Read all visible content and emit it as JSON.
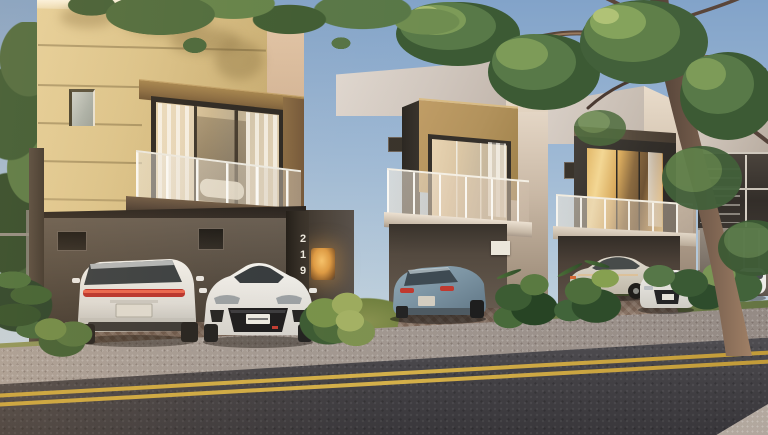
{
  "scene": {
    "type": "architectural-render",
    "description": "Golden-hour street view of a row of modern two-storey townhouses with glass balconies, carports with parked cars, tropical landscaping, a large leaning tree on the right and an asphalt road with a double yellow centre line in the foreground.",
    "house_number": "219",
    "time_of_day": "sunset golden hour",
    "houses": [
      {
        "id": "house-1",
        "facade_color": "#d9c289",
        "trim": "bronze",
        "features": [
          "textured yellow facade with horizontal grooves",
          "glass balcony railing",
          "sliding glass doors with white curtains",
          "small side window",
          "double carport",
          "unit number 219 on pillar",
          "wall lamp glow"
        ]
      },
      {
        "id": "house-2",
        "facade_color": "#d6cdc6",
        "trim": "tan",
        "features": [
          "white parapet",
          "tan window surround",
          "glass balcony",
          "single carport",
          "small white sign on carport wall"
        ]
      },
      {
        "id": "house-3",
        "facade_color": "#ccc4bc",
        "trim": "charcoal",
        "features": [
          "charcoal window box",
          "warm lit interior at dusk",
          "glass balcony",
          "carport"
        ]
      },
      {
        "id": "house-4",
        "facade_color": "#b3a899",
        "trim": "charcoal",
        "features": [
          "partially hidden behind large tree",
          "dark louvred window band"
        ]
      }
    ],
    "cars": [
      {
        "id": "white-suv-rear",
        "color": "#e9e8e4",
        "detail": "full-width red taillight bar, rear view",
        "position": "house-1 left bay"
      },
      {
        "id": "white-hatchback-front",
        "color": "#f2f1ed",
        "detail": "large black grille, front view",
        "position": "house-1 right bay"
      },
      {
        "id": "blue-grey-coupe",
        "color": "#7f99a8",
        "detail": "sloped rear glass, red taillights",
        "position": "house-2 carport"
      },
      {
        "id": "silver-sedan",
        "color": "#d3cdc0",
        "detail": "side view behind plants",
        "position": "house-3 carport"
      },
      {
        "id": "white-audi-front",
        "color": "#e8e6e2",
        "detail": "dark hexagonal grille",
        "position": "house-3 driveway"
      },
      {
        "id": "white-car-partial",
        "color": "#eceae6",
        "detail": "mostly hidden by shrubs",
        "position": "house-4 driveway"
      }
    ],
    "road": {
      "surface": "asphalt",
      "marking": "double yellow centre line",
      "marking_color": "#c8a23c"
    },
    "vegetation": [
      "dense trees on left edge",
      "large gnarled tree with green canopy on right",
      "tropical shrubs between driveways",
      "grass verge along sidewalk"
    ],
    "colors": {
      "sky_top": "#82a3c9",
      "sky_bottom": "#d3dce1",
      "facade_yellow": "#d9c289",
      "bronze": "#8a6d48",
      "grass": "#7d8a52",
      "foliage_dark": "#3f5c33",
      "foliage_light": "#8aa75e",
      "trunk": "#6b5648",
      "road": "#434145",
      "sidewalk": "#a19790",
      "lane": "#c8a23c",
      "window_glow": "#e8bc6d"
    }
  }
}
